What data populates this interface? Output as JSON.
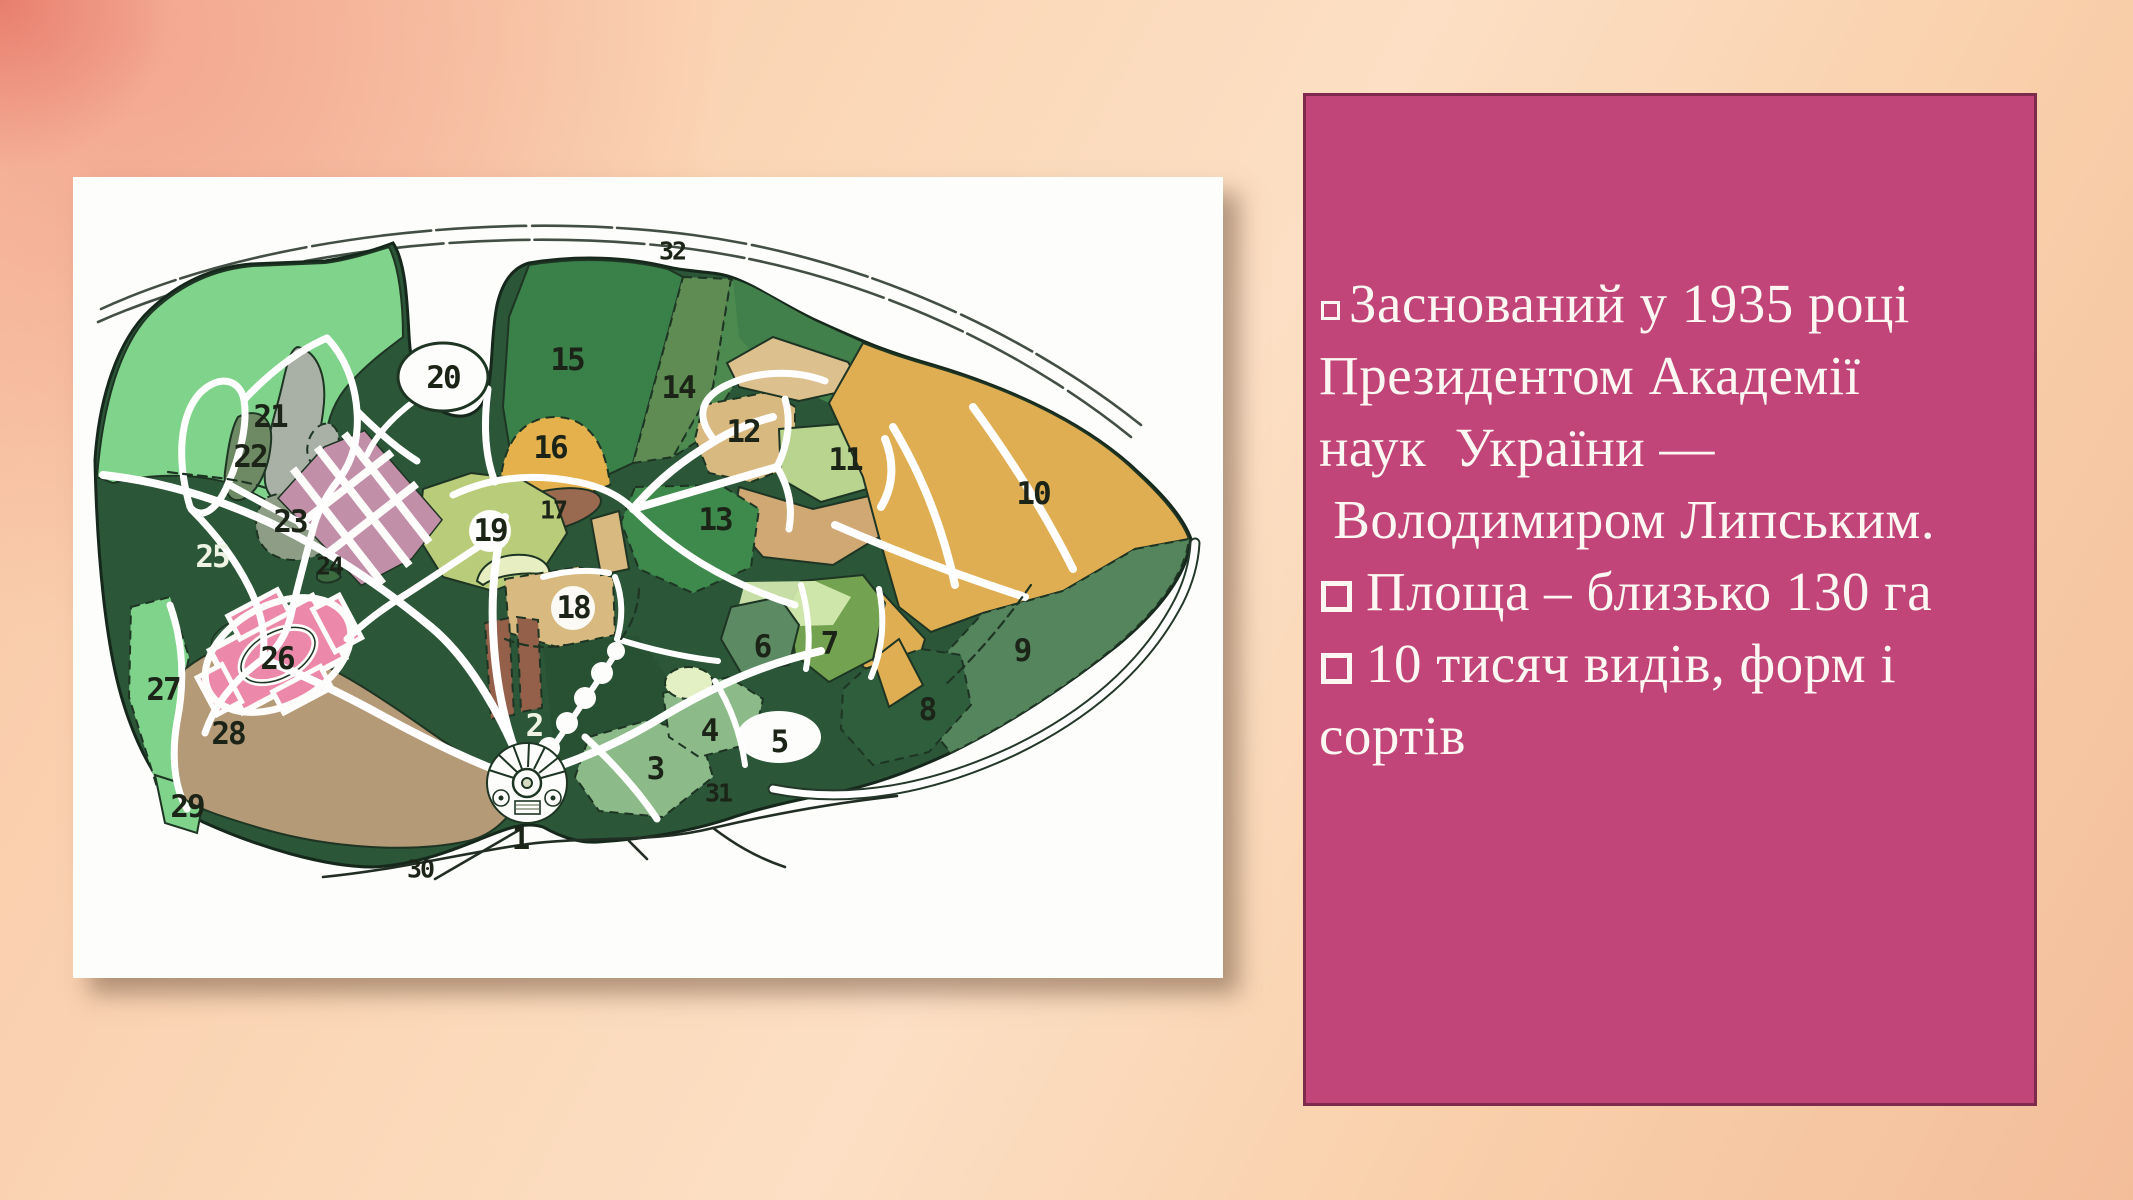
{
  "panel": {
    "background": "#c24579",
    "border_color": "#7d2a4c",
    "text_color": "#fcf7f2",
    "lines": [
      {
        "bullet": "small",
        "text": "Заснований у 1935 році"
      },
      {
        "bullet": "none",
        "text": "Президентом Академії"
      },
      {
        "bullet": "none",
        "text": "наук  України —"
      },
      {
        "bullet": "none",
        "text": " Володимиром Липським."
      },
      {
        "bullet": "large",
        "text": "Площа – близько 130 га"
      },
      {
        "bullet": "large",
        "text": "10 тисяч видів, форм і"
      },
      {
        "bullet": "none",
        "text": "сортів"
      }
    ]
  },
  "map": {
    "description": "Plan of the botanical garden with numbered zones 1-32",
    "zones": [
      {
        "label": "1",
        "x": 447,
        "y": 662,
        "tone": "dark"
      },
      {
        "label": "2",
        "x": 461,
        "y": 549,
        "tone": "light"
      },
      {
        "label": "3",
        "x": 582,
        "y": 592,
        "tone": "dark"
      },
      {
        "label": "4",
        "x": 636,
        "y": 554,
        "tone": "dark"
      },
      {
        "label": "5",
        "x": 706,
        "y": 565,
        "tone": "dark"
      },
      {
        "label": "6",
        "x": 689,
        "y": 470,
        "tone": "dark"
      },
      {
        "label": "7",
        "x": 756,
        "y": 467,
        "tone": "dark"
      },
      {
        "label": "8",
        "x": 854,
        "y": 533,
        "tone": "dark"
      },
      {
        "label": "9",
        "x": 949,
        "y": 474,
        "tone": "dark"
      },
      {
        "label": "10",
        "x": 960,
        "y": 317,
        "tone": "dark"
      },
      {
        "label": "11",
        "x": 772,
        "y": 283,
        "tone": "dark"
      },
      {
        "label": "12",
        "x": 670,
        "y": 255,
        "tone": "dark"
      },
      {
        "label": "13",
        "x": 642,
        "y": 343,
        "tone": "dark"
      },
      {
        "label": "14",
        "x": 605,
        "y": 211,
        "tone": "dark"
      },
      {
        "label": "15",
        "x": 494,
        "y": 183,
        "tone": "dark"
      },
      {
        "label": "16",
        "x": 477,
        "y": 271,
        "tone": "dark"
      },
      {
        "label": "17",
        "x": 480,
        "y": 333,
        "tone": "dark",
        "small": true
      },
      {
        "label": "18",
        "x": 500,
        "y": 431,
        "tone": "dark"
      },
      {
        "label": "19",
        "x": 417,
        "y": 354,
        "tone": "dark"
      },
      {
        "label": "20",
        "x": 370,
        "y": 201,
        "tone": "dark"
      },
      {
        "label": "21",
        "x": 197,
        "y": 240,
        "tone": "dark"
      },
      {
        "label": "22",
        "x": 177,
        "y": 280,
        "tone": "dark"
      },
      {
        "label": "23",
        "x": 217,
        "y": 345,
        "tone": "dark"
      },
      {
        "label": "24",
        "x": 256,
        "y": 389,
        "tone": "dark",
        "small": true
      },
      {
        "label": "25",
        "x": 139,
        "y": 380,
        "tone": "light"
      },
      {
        "label": "26",
        "x": 204,
        "y": 482,
        "tone": "dark"
      },
      {
        "label": "27",
        "x": 90,
        "y": 513,
        "tone": "dark"
      },
      {
        "label": "28",
        "x": 155,
        "y": 557,
        "tone": "dark"
      },
      {
        "label": "29",
        "x": 114,
        "y": 630,
        "tone": "dark"
      },
      {
        "label": "30",
        "x": 347,
        "y": 692,
        "tone": "dark",
        "small": true
      },
      {
        "label": "31",
        "x": 645,
        "y": 616,
        "tone": "dark",
        "small": true
      },
      {
        "label": "32",
        "x": 599,
        "y": 74,
        "tone": "dark",
        "small": true
      }
    ],
    "colors": {
      "base_dark_green": "#2b5638",
      "light_green": "#7fd38b",
      "green_15": "#3a8049",
      "green_14": "#4c8a4f",
      "green_13": "#3e8a4c",
      "olive_band": "#5e8c52",
      "yellow_16": "#e5b14d",
      "mustard_10": "#e0ae52",
      "tan_12_18": "#d8b97f",
      "tan_parcel": "#cfa873",
      "light_11": "#b8d48f",
      "light_19": "#b9cc79",
      "pale_crescent": "#e7efc2",
      "brown_17": "#9a6a50",
      "brown_2": "#95604a",
      "light_3": "#8cba88",
      "speckle": "#e3f0c3",
      "tan_28": "#b49a76",
      "grey_21": "#a9b0a6",
      "olive_22": "#6e8a64",
      "grey_23": "#8e9d85",
      "mauve_24": "#c28fa9",
      "pink_26": "#ec89aa",
      "sage_9": "#55855c",
      "dark_8": "#2f5e3d",
      "olive_7": "#73a350",
      "sage_6": "#5c8a63"
    }
  }
}
